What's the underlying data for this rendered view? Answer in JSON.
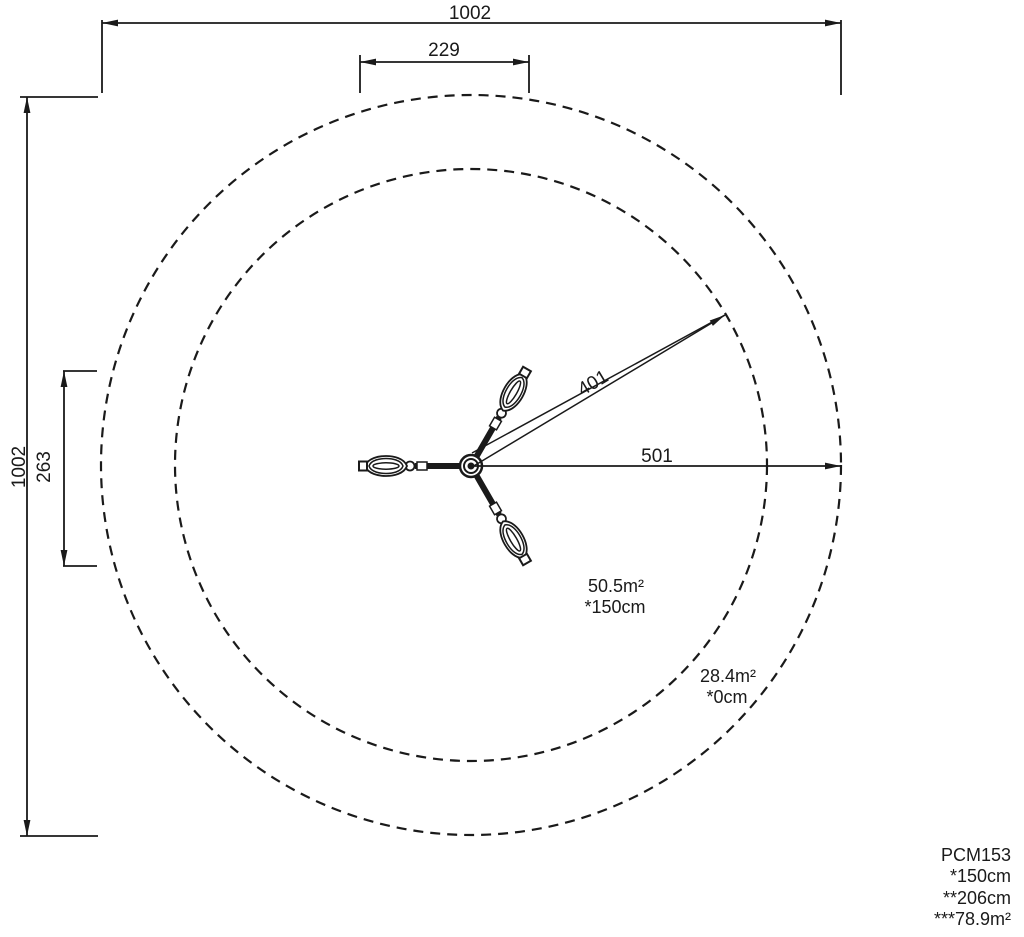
{
  "drawing": {
    "dimension_labels": {
      "overall_width": "1002",
      "overall_height": "1002",
      "equipment_width": "229",
      "equipment_height": "263",
      "hatched_zone_radius": "401",
      "safety_zone_radius": "501"
    },
    "annotations": {
      "hatched_zone": {
        "area": "50.5m²",
        "note": "*150cm"
      },
      "clear_zone": {
        "area": "28.4m²",
        "note": "*0cm"
      }
    },
    "legend": {
      "product_code": "PCM153",
      "lines": [
        "*150cm",
        "**206cm",
        "***78.9m²"
      ]
    },
    "colors": {
      "line": "#1a1a1a",
      "background": "#ffffff"
    }
  }
}
